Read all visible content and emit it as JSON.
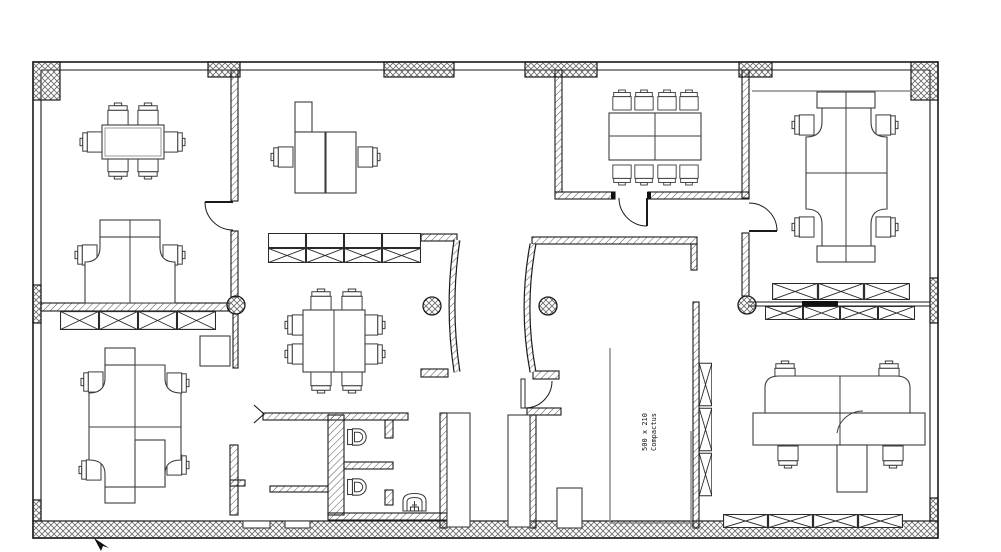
{
  "floor_plan": {
    "compactus_label": {
      "line1": "Compactus",
      "line2": "500 x 210"
    },
    "colors": {
      "background": "#ffffff",
      "wall_line": "#1a1a1a",
      "hatch": "#555555",
      "furniture_line": "#3d3d3d",
      "accent_gray": "#8c8c8c"
    },
    "legend": {
      "rooms": [
        "office-top-left",
        "open-office-center",
        "conference-room-top-center",
        "team-office-top-right",
        "team-office-bottom-left",
        "team-office-bottom-right",
        "restrooms",
        "compactus-archive"
      ],
      "furniture": [
        "meeting-table",
        "conference-table",
        "workstation-pod",
        "task-chair",
        "storage-cabinet",
        "toilet",
        "urinal",
        "structural-column",
        "door-swing"
      ]
    },
    "counts": {
      "chairs": 38,
      "tables": 3,
      "workstation_pods": 5,
      "structural_columns": 4,
      "doors": 4,
      "toilets": 2,
      "urinals": 1,
      "storage_cabinet_runs": 6
    }
  }
}
